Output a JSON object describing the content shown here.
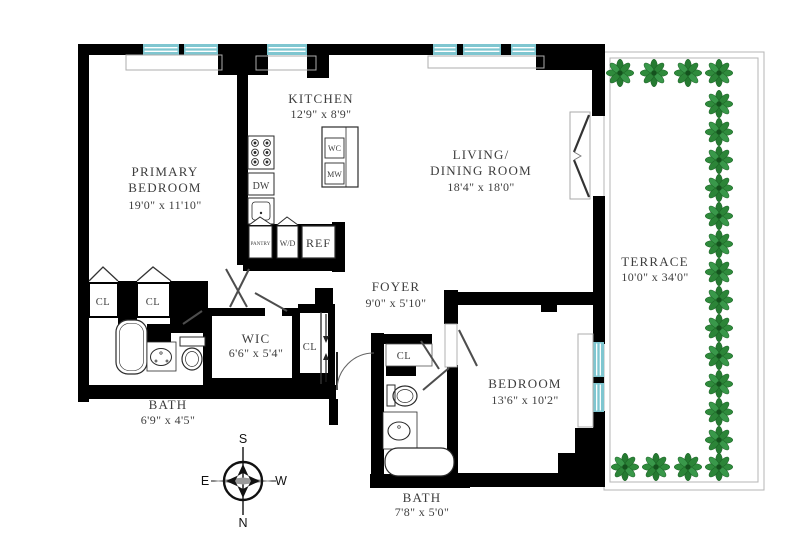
{
  "rooms": {
    "primary_bedroom": {
      "name_line1": "PRIMARY",
      "name_line2": "BEDROOM",
      "dims": "19'0\" x 11'10\""
    },
    "kitchen": {
      "name_line1": "KITCHEN",
      "dims": "12'9\" x 8'9\""
    },
    "living_dining": {
      "name_line1": "LIVING/",
      "name_line2": "DINING ROOM",
      "dims": "18'4\" x 18'0\""
    },
    "terrace": {
      "name_line1": "TERRACE",
      "dims": "10'0\" x 34'0\""
    },
    "foyer": {
      "name_line1": "FOYER",
      "dims": "9'0\" x 5'10\""
    },
    "wic": {
      "name_line1": "WIC",
      "dims": "6'6\" x 5'4\""
    },
    "bath_primary": {
      "name_line1": "BATH",
      "dims": "6'9\" x 4'5\""
    },
    "bedroom": {
      "name_line1": "BEDROOM",
      "dims": "13'6\" x 10'2\""
    },
    "bath_second": {
      "name_line1": "BATH",
      "dims": "7'8\" x 5'0\""
    }
  },
  "closets": {
    "cl1": "CL",
    "cl2": "CL",
    "cl3": "CL",
    "cl4": "CL"
  },
  "appliances": {
    "dw": "DW",
    "wc": "WC",
    "mw": "MW",
    "pantry": "PANTRY",
    "wd": "W/D",
    "ref": "REF"
  },
  "compass": {
    "north": "N",
    "south": "S",
    "east": "E",
    "west": "W"
  },
  "colors": {
    "wall": "#000000",
    "window": "#7fc6d0",
    "plant_dark": "#257a31",
    "plant_light": "#39984a",
    "text": "#3d3d3d"
  }
}
